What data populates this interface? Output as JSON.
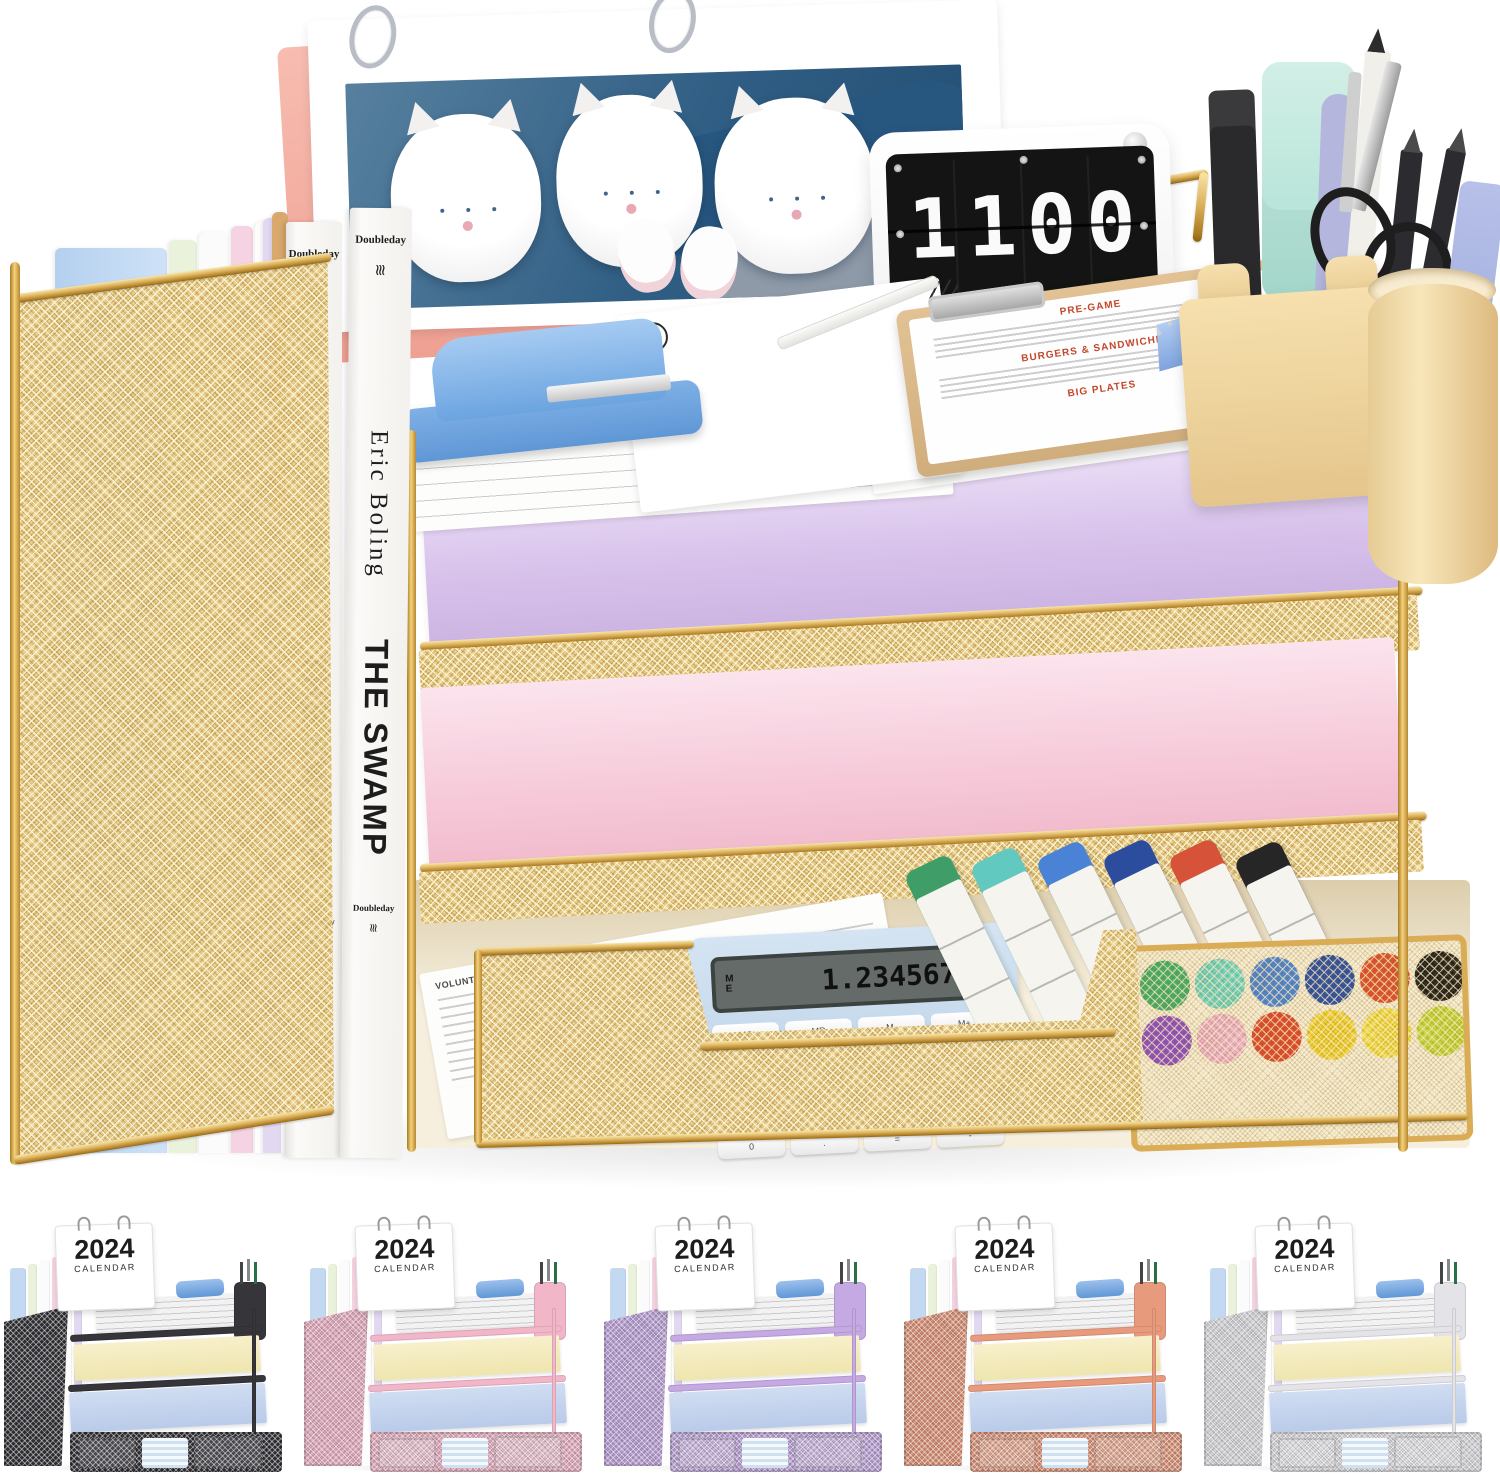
{
  "page": {
    "background": "#ffffff",
    "description": "Product photo of a 4-tier gold mesh desktop file organizer with magazine holder, desk calendar, flip clock and stationery"
  },
  "scene": {
    "books": {
      "publisher": "Doubleday",
      "logo_glyph": "≋",
      "author": "Eric Boling",
      "title": "THE SWAMP"
    },
    "flip_clock": {
      "time": "1100"
    },
    "clipboard_menu": {
      "sections": [
        "PRE-GAME",
        "BURGERS & SANDWICHES",
        "BIG PLATES"
      ]
    },
    "top_tray_paper_label": "LETTER",
    "drawer": {
      "letter_heading": "VOLUNTEER APPOINTMENT LETTER",
      "calculator": {
        "memory_indicator": "ME",
        "display": "1.2345678",
        "keys": [
          "MC",
          "MR",
          "M-",
          "M+",
          "7",
          "8",
          "9",
          "%",
          "4",
          "5",
          "6",
          "×",
          "1",
          "2",
          "3",
          "+/-",
          "0",
          ".",
          "=",
          "-"
        ]
      },
      "marker_cap_colors": [
        "#3f9e68",
        "#62c9c0",
        "#4a82d6",
        "#2c4d9e",
        "#d65238",
        "#262626"
      ],
      "dot_colors": [
        "#43b06c",
        "#6fd8c8",
        "#4a86d9",
        "#2a4fa8",
        "#e0512f",
        "#1f1f1f",
        "#8e4fc4",
        "#f0b3cf",
        "#e04a2f",
        "#f2d435",
        "#f5e04a",
        "#c6d93f"
      ]
    },
    "colors": {
      "gold_wire": "#d9ac55",
      "gold_mesh": "#ecd28e",
      "cream_cup": "#f0d7a2",
      "stapler_blue": "#7fb0e6",
      "purple_paper": "#d9c4ec",
      "pink_paper": "#f6c9d9",
      "calendar_pink": "#f5b3a6",
      "calculator_blue": "#c7dbee",
      "mint_highlighter": "#bfe8dc"
    }
  },
  "thumbnails": {
    "year": "2024",
    "calendar_label": "CALENDAR",
    "variants": [
      {
        "name": "black",
        "frame": "#35353a",
        "mesh": "#56565c"
      },
      {
        "name": "pink",
        "frame": "#f2b6c9",
        "mesh": "#f7cedb"
      },
      {
        "name": "purple",
        "frame": "#c5a9e2",
        "mesh": "#d6c1ec"
      },
      {
        "name": "rose-gold",
        "frame": "#e89a7d",
        "mesh": "#f2b49b"
      },
      {
        "name": "white",
        "frame": "#e4e4e8",
        "mesh": "#f0f0f3"
      }
    ]
  }
}
